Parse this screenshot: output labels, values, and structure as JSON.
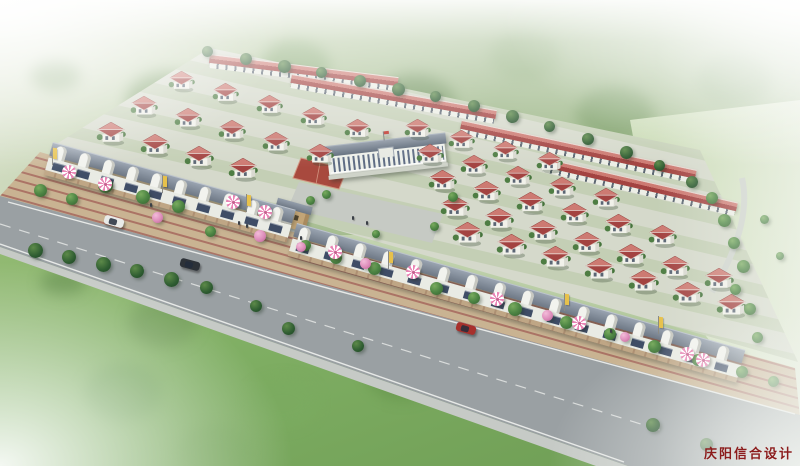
{
  "scene": {
    "type": "aerial architectural rendering",
    "subject": "planned residential community: red-roof villas, street-front shops, central public building with basketball court, tree-lined highway with cars",
    "watermark": {
      "text": "庆阳信合设计",
      "color": "#8b1c1c"
    }
  },
  "palette": {
    "roof_red_light": "#cd7a72",
    "roof_red_dark": "#a34341",
    "villa_wall": "#f1f1ea",
    "shop_roof_light": "#99a3b0",
    "shop_roof_dark": "#6e7885",
    "shop_wall": "#e9ebe4",
    "shop_window": "#3f4d66",
    "central_roof": "#5f6b7a",
    "walkway_tan": "#bfa685",
    "paving_red": "#ab7365",
    "road_gray": "#9aa0a3",
    "road_line": "#f5f6f4",
    "plot_ground": "#d3d8c9",
    "plaza_gray": "#c6cac4",
    "court_red": "#a8493e",
    "field_green": "#83af66",
    "forest_green": "#9db988",
    "tree_dark": "#2e5c31",
    "tree_mid": "#4d8544",
    "tree_light": "#79ab5e",
    "flower_pink": "#dd8cba",
    "banner_yellow": "#e7c14b",
    "umbrella_pink": "#e985b5",
    "watermark_red": "#8b1c1c"
  },
  "inventory": {
    "villa_count": 43,
    "rowhouse_strip_count": 4,
    "shop_rows": [
      {
        "units": 10
      },
      {
        "units": 16
      }
    ],
    "umbrella_count": 10,
    "banner_count": 6,
    "cars": [
      {
        "name": "white-car",
        "color": "#e9eae8"
      },
      {
        "name": "dark-car",
        "color": "#2d3238"
      },
      {
        "name": "red-car",
        "color": "#a7302c"
      }
    ]
  }
}
